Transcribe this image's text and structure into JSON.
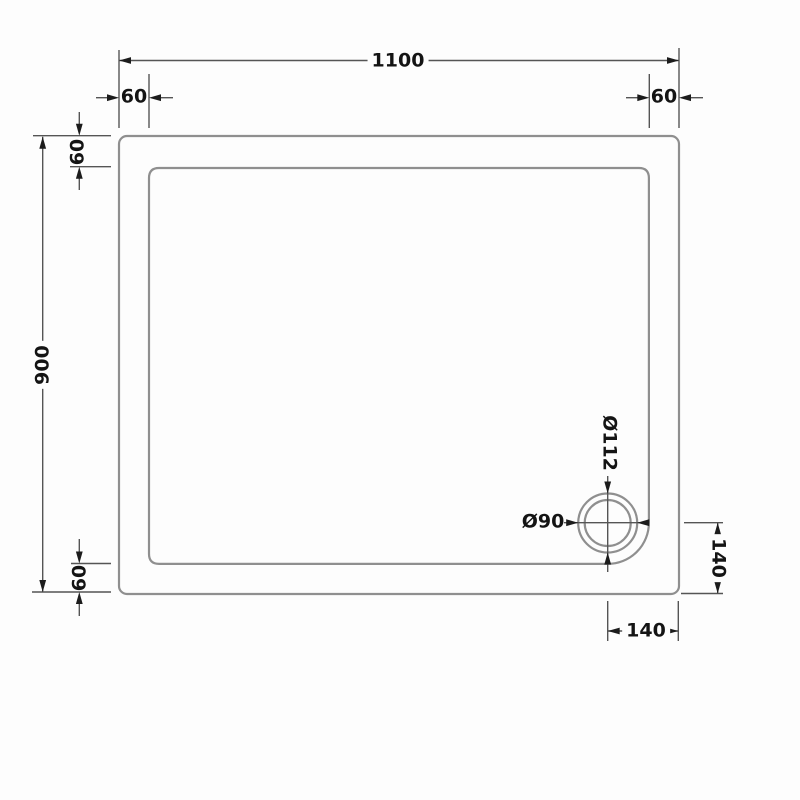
{
  "drawing": {
    "labels": {
      "overall_width": "1100",
      "overall_height": "900",
      "edge_top_left": "60",
      "edge_top_right": "60",
      "edge_left_top": "60",
      "edge_left_bottom": "60",
      "waste_outer_dia": "Ø112",
      "waste_inner_dia": "Ø90",
      "waste_from_right": "140",
      "waste_from_bottom": "140"
    },
    "colors": {
      "background": "#fdfdfd",
      "tray_outline": "#8f8f8f",
      "dimension_line": "#555555",
      "arrow": "#1c1c1c",
      "text": "#141414"
    }
  }
}
